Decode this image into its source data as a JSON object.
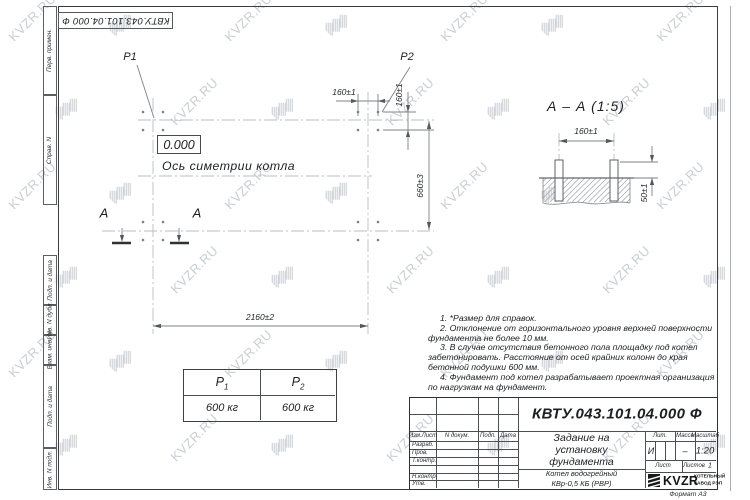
{
  "watermark": {
    "text": "KVZR.RU"
  },
  "sheet": {
    "stamp_top": "КВТУ.043.101.04.000  Ф",
    "format_label": "Формат А3",
    "margin_labels": [
      "Перв. примен.",
      "Справ. N",
      "Подп. и дата",
      "Инв. N дубл.",
      "Взам. инв. N",
      "Подп. и дата",
      "Инв. N подл."
    ]
  },
  "plan": {
    "p1": "P1",
    "p2": "P2",
    "elevation": "0.000",
    "axis_label": "Ось симетрии котла",
    "dim_top": "160±1",
    "dim_side": "160±1",
    "dim_height": "660±3",
    "dim_width": "2160±2",
    "section_letter_left": "А",
    "section_letter_right": "А"
  },
  "section_view": {
    "title": "А – А (1:5)",
    "dim_span": "160±1",
    "dim_protrusion": "50±1"
  },
  "load_table": {
    "col1_base": "Р",
    "col1_sub": "1",
    "col2_base": "Р",
    "col2_sub": "2",
    "val1": "600 кг",
    "val2": "600 кг"
  },
  "notes": [
    "1. *Размер для справок.",
    "2. Отклонение от горизонтального уровня верхней поверхности фундамента не более 10 мм.",
    "3. В случае отсутствия бетонного пола площадку под котел забетонировать. Расстояние от осей крайних колонн до края бетонной подушки 600 мм.",
    "4. Фундамент под котел разрабатывает проектная организация по нагрузкам на фундамент."
  ],
  "title_block": {
    "doc_number": "КВТУ.043.101.04.000  Ф",
    "doc_title": "Задание на установку фундамента",
    "product_1": "Котел водогрейный",
    "product_2": "КВр-0,5 КБ (РВР)",
    "col_izm": "Изм.Лист",
    "col_doc": "N докум.",
    "col_podp": "Подп.",
    "col_data": "Дата",
    "row_razrab": "Разраб.",
    "row_prov": "Пров.",
    "row_tkontr": "Т.контр.",
    "row_nkontr": "Н.контр.",
    "row_utv": "Утв.",
    "lit_label": "Лит.",
    "lit_value": "И",
    "massa_label": "Масса",
    "massa_value": "–",
    "masshtab_label": "Масштаб",
    "masshtab_value": "1:20",
    "list_label": "Лист",
    "listov_label": "Листов",
    "listov_value": "1",
    "logo_text": "KVZR",
    "logo_caption_1": "КОТЕЛЬНЫЙ",
    "logo_caption_2": "ЗАВОД РЭП"
  }
}
